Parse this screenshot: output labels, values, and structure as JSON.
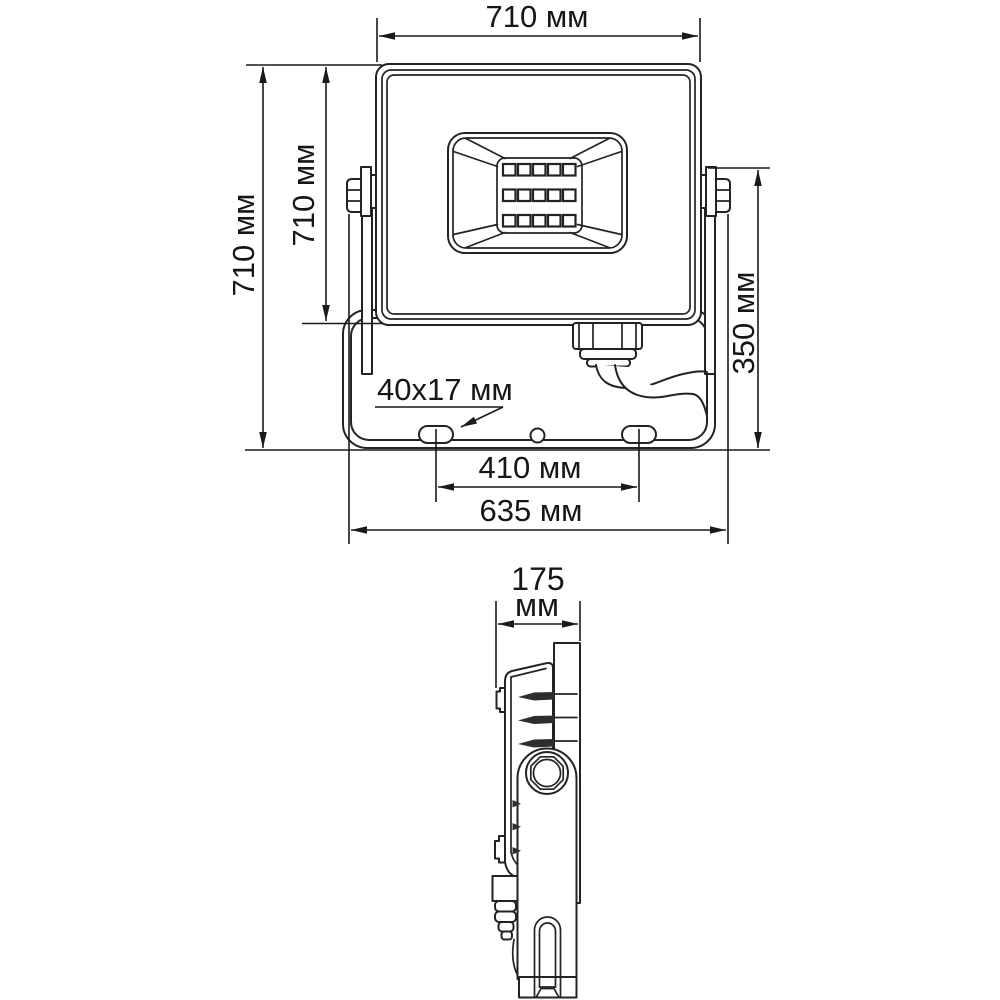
{
  "page": {
    "background": "#ffffff",
    "line_color": "#232323",
    "dimension_color": "#1a1a1a",
    "unit": "мм"
  },
  "front_view": {
    "dim_width_top": "710 мм",
    "dim_height_overall": "710 мм",
    "dim_height_body": "710 мм",
    "dim_height_bracket": "350 мм",
    "slot_size_label": "40x17 мм",
    "dim_slot_spacing": "410 мм",
    "dim_bracket_width": "635 мм",
    "led_rows": 3,
    "led_columns": 5
  },
  "side_view": {
    "dim_depth_value": "175",
    "dim_depth_unit": "мм"
  }
}
